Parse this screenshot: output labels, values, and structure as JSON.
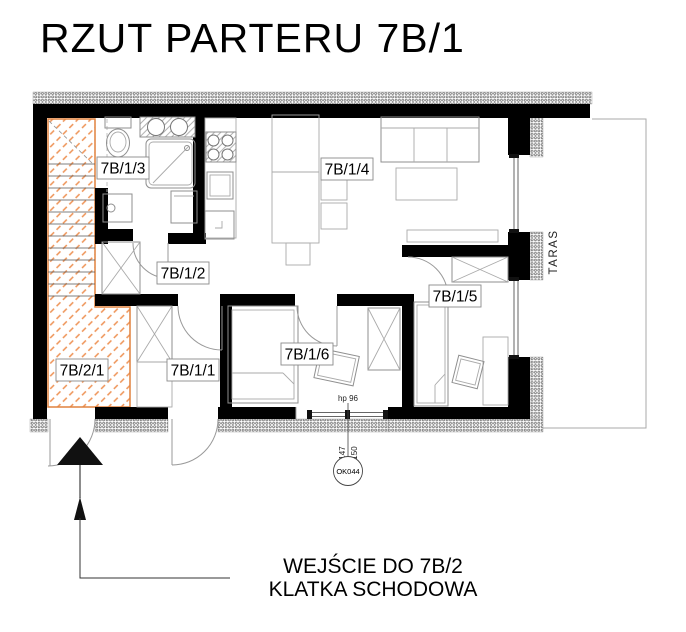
{
  "title": "RZUT PARTERU 7B/1",
  "rooms": [
    {
      "label": "7B/1/3"
    },
    {
      "label": "7B/1/4"
    },
    {
      "label": "7B/1/2"
    },
    {
      "label": "7B/1/5"
    },
    {
      "label": "7B/2/1"
    },
    {
      "label": "7B/1/1"
    },
    {
      "label": "7B/1/6"
    }
  ],
  "terrace": {
    "label": "TARAS"
  },
  "window_annotation": {
    "sill_height": "hp 96",
    "dim_inner": "147",
    "dim_outer": "150",
    "window_mark": "OK044"
  },
  "entrance_note": {
    "line1": "WEJŚCIE DO 7B/2",
    "line2": "KLATKA SCHODOWA"
  },
  "colors": {
    "wall": "#000000",
    "stair_hatch": "#ee9254",
    "stair_border": "#e0823f",
    "furniture_line": "#8f8f8f"
  }
}
